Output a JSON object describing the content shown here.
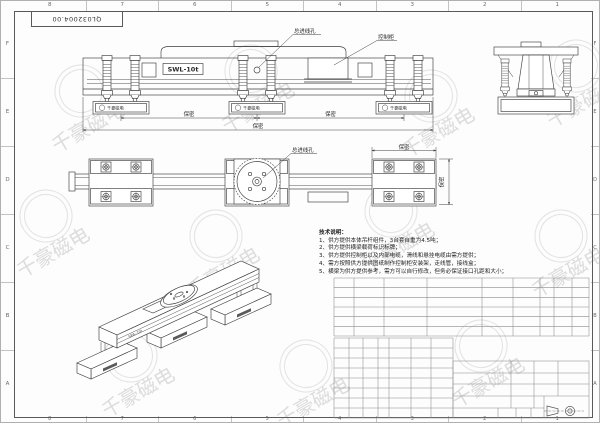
{
  "sheet": {
    "drawing_number": "QL032004.00",
    "watermark_text": "千豪磁电",
    "zone_numbers": [
      "8",
      "7",
      "6",
      "5",
      "4",
      "3",
      "2",
      "1"
    ],
    "zone_letters": [
      "F",
      "E",
      "D",
      "C",
      "B",
      "A"
    ]
  },
  "front_view": {
    "label": "SWL-10t",
    "callout_inlet": "总进线孔",
    "callout_cabinet": "控制柜",
    "dim_span_left": "保密",
    "dim_span_right": "保密",
    "dim_overall": "保密",
    "brand": "千豪磁电"
  },
  "top_view": {
    "callout_inlet": "总进线孔",
    "dim_width": "保密",
    "dim_depth": "保密"
  },
  "iso_view": {
    "label": "SWL-10t"
  },
  "notes": {
    "title": "技术说明：",
    "items": [
      "1、供方提供本体吊杆组件，3台套自重为4.5吨；",
      "2、供方提供横梁载荷标识标牌；",
      "3、供方提供控制柜以及内部电缆，滑线和悬挂电缆由需方提供；",
      "4、需方按照供方提供图纸制作控制柜安装架，走线管，接线盒；",
      "5、横梁为供方提供参考，需方可以自行修改，但务必保证接口孔距和大小；"
    ]
  }
}
